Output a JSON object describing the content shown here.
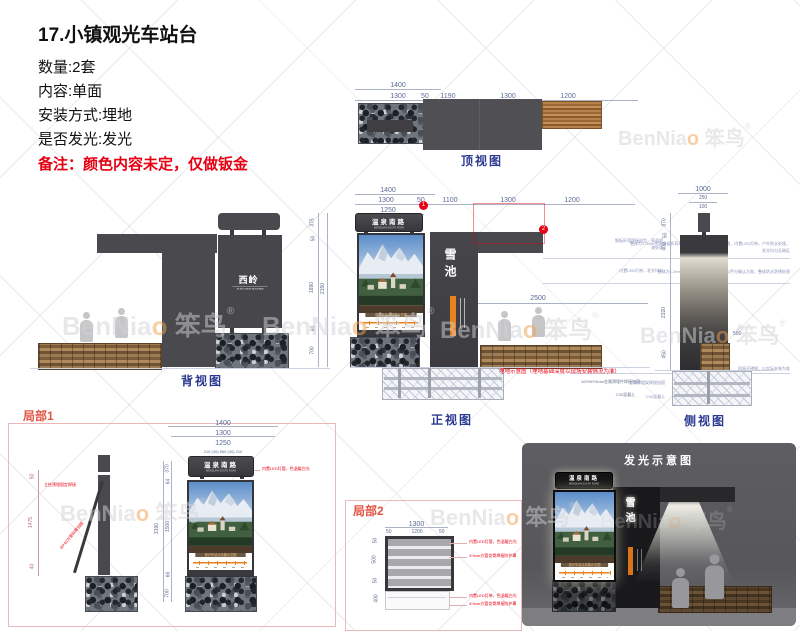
{
  "header": {
    "title": "17.小镇观光车站台",
    "spec1": "数量:2套",
    "spec2": "内容:单面",
    "spec3": "安装方式:埋地",
    "spec4": "是否发光:发光",
    "note": "备注：颜色内容未定，仅做钣金"
  },
  "watermark": {
    "en": "BenNia",
    "o": "o",
    "cn": "笨鸟",
    "reg": "®"
  },
  "signbox": {
    "title": "温泉南路",
    "subtitle": "WENQUAN SOUTH ROAD",
    "route_text": "观光车站点线路示意图"
  },
  "column_sign": {
    "name": "雪池"
  },
  "back_logo": {
    "text": "西岭",
    "dot": "·",
    "sub": "XILING SNOW MOUNTAIN"
  },
  "colors": {
    "accent_orange": "#e8821e",
    "note_red": "#e60012",
    "label_blue": "#2b3990",
    "structure_grey": "#47474b"
  },
  "views": {
    "top": {
      "label": "顶视图",
      "d1400": "1400",
      "d1300": "1300",
      "d50": "50",
      "d1250": "1250",
      "w1": "1190",
      "w2": "1300",
      "w3": "1200"
    },
    "back": {
      "label": "背视图",
      "h375": "375",
      "h50": "50",
      "h1890": "1890",
      "h60": "60",
      "h700": "700",
      "total": "2150"
    },
    "front": {
      "label": "正视图",
      "d1400": "1400",
      "d1300": "1300",
      "d50": "50",
      "d1250": "1250",
      "w1100": "1100",
      "w1300": "1300",
      "w1200": "1200",
      "m1": "1",
      "m2": "2",
      "h2500": "2500",
      "note_red": "埋地示意图（埋地基础深度以现场安装情况为准）",
      "note_embed": "100*50*3mm金属预埋件焊接加固",
      "note_concrete": "C30混凝土",
      "ann1": "整体为1.2mm优质钢板折弯焊接成型，表面打磨喷漆处理，内置LED灯带，户外防水处理，发光均匀无暗区",
      "ann2": "整体为1.2mm优质钢板折弯成型，颜色以甲方确认为准，整体防水防锈处理",
      "ann3": "四周不锈钢，以实际安装为准"
    },
    "side": {
      "label": "侧视图",
      "t1000": "1000",
      "t250": "250",
      "t100": "100",
      "l370": "370",
      "l50": "50",
      "l400": "400",
      "l2320": "2320",
      "l450": "450",
      "r500": "500",
      "ann1": "钢板折弯焊接成型，表面喷漆处理",
      "ann2": "内置LED灯带，发光均匀",
      "ann3": "金属预埋架焊接加固",
      "ann4": "C30混凝土"
    },
    "detail1": {
      "label": "局部1",
      "d1400": "1400",
      "d1300": "1300",
      "d1250": "1250",
      "seg": "210 (40)   650   (40) 210",
      "v370": "370",
      "v64": "64",
      "v1500": "1500",
      "v3190": "3190",
      "v66": "66",
      "v700": "700",
      "s50": "50",
      "s1475": "1475",
      "s40": "40",
      "note1": "立柱预埋固定焊接",
      "note2": "40*40方管斜撑加固",
      "note3": "内置LED灯管，色温暖白光"
    },
    "detail2": {
      "label": "局部2",
      "d1300": "1300",
      "dl50": "50",
      "d1200": "1200",
      "dr50": "50",
      "l50a": "50",
      "l500": "500",
      "l50b": "50",
      "l400": "400",
      "note1": "内置LED灯管，色温暖白光",
      "note2": "4*4cm方管龙骨焊接防护罩",
      "note3": "内置LED灯带，色温暖白光",
      "note4": "4*4cm方管龙骨焊接防护罩"
    },
    "glow": {
      "label": "发光示意图"
    }
  }
}
